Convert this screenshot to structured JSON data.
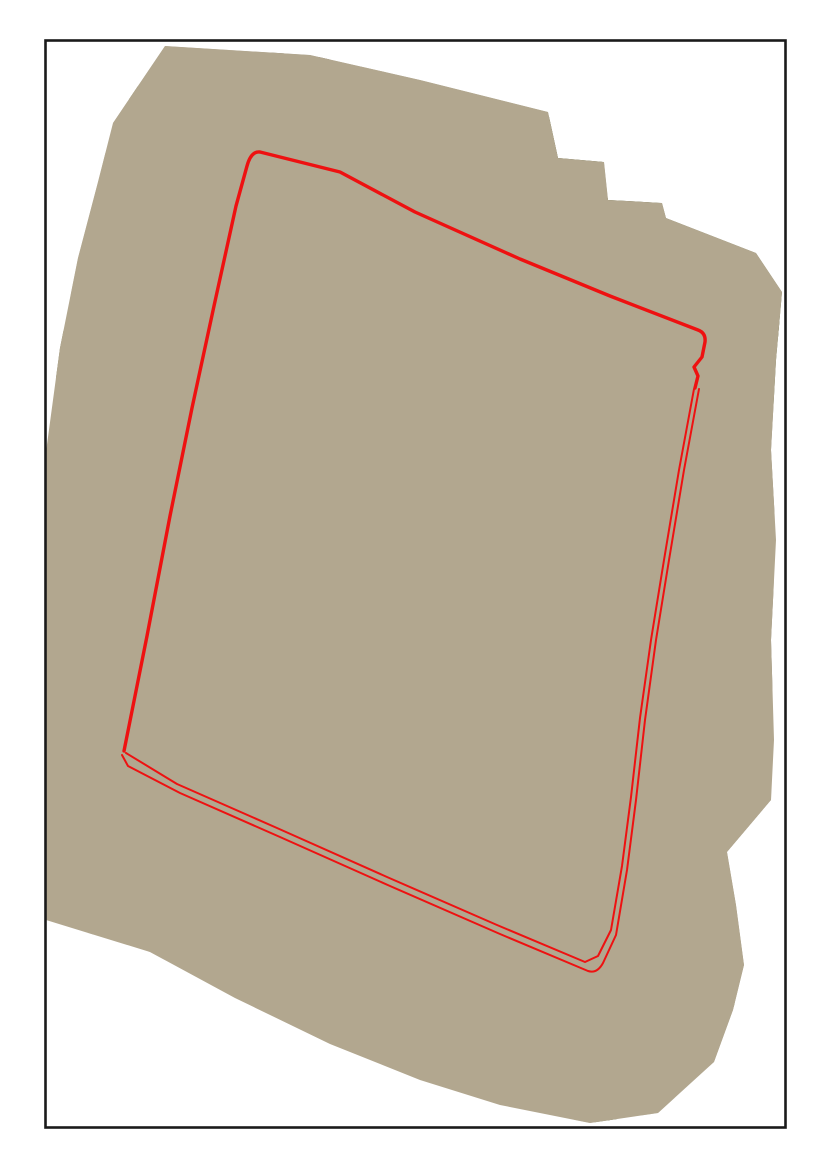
{
  "colors": {
    "page_background": "#ffffff",
    "frame_border": "#1a1a1a",
    "boundary_red": "#ee1111"
  },
  "scene": {
    "width": 830,
    "height": 1174,
    "bg": "#ffffff",
    "frame": {
      "x": 45.5,
      "y": 40.5,
      "w": 740,
      "h": 1087,
      "stroke": "#1a1a1a",
      "sw": 2.6
    },
    "footprint": {
      "points": "165,46 310,55 420,80 548,112 558,158 604,162 608,200 662,203 666,218 756,253 782,292 776,360 771,450 776,540 771,640 774,740 771,800 727,852 736,905 744,965 733,1010 714,1062 658,1113 590,1123 500,1105 420,1080 330,1044 235,998 150,952 46,920 46,452 60,348 78,258 98,182 113,123"
    },
    "gridquad": {
      "points": "258,150 703,334 583,966 123,752"
    },
    "layers": [
      {
        "t": "poly",
        "n": "footprint-base",
        "clip": "frame",
        "p": "165,46 310,55 420,80 548,112 558,158 604,162 608,200 662,203 666,218 756,253 782,292 776,360 771,450 776,540 771,640 774,740 771,800 727,852 736,905 744,965 733,1010 714,1062 658,1113 590,1123 500,1105 420,1080 330,1044 235,998 150,952 46,920 46,452 60,348 78,258 98,182 113,123",
        "f": "#b2a78f"
      },
      {
        "t": "poly",
        "n": "top-rubble-band",
        "p": "113,123 165,46 310,55 420,80 548,112 558,158 604,162 608,200 650,202 560,226 420,182 250,142 150,122",
        "f": "#a89f90"
      },
      {
        "t": "poly",
        "n": "field-green-top-1",
        "p": "288,58 352,66 350,96 286,88",
        "f": "#8e9465"
      },
      {
        "t": "poly",
        "n": "field-green-top-2",
        "p": "420,92 500,112 495,140 415,120",
        "f": "#87905f"
      },
      {
        "t": "ells",
        "n": "pond-pale-top",
        "items": [
          [
            372,
            74,
            15,
            10,
            15
          ]
        ],
        "f": "#ccc6b5"
      },
      {
        "t": "rects",
        "n": "buildings-top-row",
        "items": [
          [
            232,
            52,
            13,
            9,
            18,
            "#dcd8d0"
          ],
          [
            252,
            58,
            10,
            7,
            18,
            "#b0aba0"
          ],
          [
            278,
            52,
            12,
            9,
            18,
            "#8b8577"
          ],
          [
            300,
            63,
            10,
            7,
            18,
            "#e4e1da"
          ],
          [
            324,
            60,
            11,
            7,
            18,
            "#6f6a5c"
          ],
          [
            348,
            68,
            9,
            6,
            18,
            "#cfcabf"
          ]
        ]
      },
      {
        "t": "poly",
        "n": "water-dark-mass",
        "p": "548,116 602,160 606,198 662,203 666,218 756,253 782,292 776,405 700,390 640,330 592,262 556,205 538,158",
        "f": "#5b663f"
      },
      {
        "t": "poly",
        "n": "water-dark-blob",
        "p": "600,240 700,285 690,322 590,276",
        "f": "#4e5936",
        "o": 0.85
      },
      {
        "t": "path",
        "n": "canal-top",
        "d": "M132,92 L260,132 L420,190 L600,258 L710,300 L782,330",
        "s": "#6c7145",
        "w": 16
      },
      {
        "t": "path",
        "n": "road-top",
        "d": "M124,80 L260,118 L420,172 L600,242 L720,288 L782,314",
        "s": "#d9d4c4",
        "w": 5
      },
      {
        "t": "poly",
        "n": "pale-patch-topleft",
        "p": "90,150 140,160 120,320 70,300",
        "f": "#cac3b2"
      },
      {
        "t": "ells",
        "n": "ponds-olive-topleft",
        "items": [
          [
            170,
            128,
            13,
            22,
            -18
          ],
          [
            156,
            190,
            11,
            20,
            -12
          ]
        ],
        "f": "#6f7448"
      },
      {
        "t": "path",
        "n": "levee-left",
        "d": "M52,310 L80,470 L108,610 L128,720 L140,772",
        "s": "#7b7c4f",
        "w": 16,
        "o": 0.95
      },
      {
        "t": "poly",
        "n": "strip-olive-left",
        "p": "118,372 148,384 86,676 58,660",
        "f": "#8a8a60"
      },
      {
        "t": "poly",
        "n": "strip-bright-left",
        "p": "150,385 198,403 136,700 88,678",
        "f": "#d6d0c1"
      },
      {
        "t": "poly",
        "n": "strip-outside-1",
        "p": "168,258 190,267 128,543 106,534",
        "f": "#c9c2b1"
      },
      {
        "t": "poly",
        "n": "strip-outside-2",
        "p": "196,268 216,277 154,553 134,544",
        "f": "#8f8d6a"
      },
      {
        "t": "poly",
        "n": "strip-outside-3",
        "p": "222,278 238,285 176,561 160,554",
        "f": "#b3ab97"
      },
      {
        "t": "poly",
        "n": "pond-dikes-underlay",
        "clip": "grid",
        "p": "258,150 703,334 583,966 123,752",
        "f": "#6e6c4a"
      },
      {
        "t": "grid",
        "n": "pond-grid",
        "clip": "grid",
        "origin": [
          258,
          130
        ],
        "u": [
          57,
          14
        ],
        "v": [
          -12,
          52
        ],
        "inset": 0.94,
        "palette": {
          "0": "#b7ae9d",
          "1": "#a79d8a",
          "2": "#99937a",
          "3": "#8e9766",
          "4": "#7e8b55",
          "5": "#c9c2b2",
          "6": "#a0a07f",
          "7": "#6f7c49",
          "8": "#cfcabc",
          "9": "#90856f"
        },
        "rows": [
          "236323447",
          "125163344",
          "212902374",
          "105816243",
          "051523647",
          "100582334",
          "015106247",
          "509212334",
          "011586244",
          "150123637",
          "015012344",
          "201586237",
          "120152344",
          "015216237",
          "101523444"
        ]
      },
      {
        "t": "strips",
        "n": "strip-ponds-inner",
        "clip": "grid",
        "start": [
          150,
          545
        ],
        "step": [
          -6,
          27
        ],
        "u": [
          165,
          -38
        ],
        "v": [
          5,
          20
        ],
        "colors": [
          "#cbc3b2",
          "#9b9780",
          "#b4ac98",
          "#8f9168",
          "#c6bfae",
          "#a39c86",
          "#d2ccbd",
          "#96937a"
        ]
      },
      {
        "t": "path",
        "n": "margin-green-top",
        "clip": "grid",
        "d": "M268,162 L420,222 L560,278 L695,334",
        "s": "#83905a",
        "w": 11,
        "o": 0.85
      },
      {
        "t": "path",
        "n": "margin-green-right",
        "clip": "grid",
        "d": "M698,345 L676,470 L660,570 L648,670 L637,780 L627,870 L615,940 L592,960",
        "s": "#7e8b52",
        "w": 15,
        "o": 0.95
      },
      {
        "t": "path",
        "n": "margin-sand-bottom",
        "clip": "grid",
        "d": "M135,755 L300,830 L460,900 L575,955",
        "s": "#c5bca6",
        "w": 12,
        "o": 0.8
      },
      {
        "t": "ells",
        "n": "tone-light-overlays",
        "items": [
          [
            350,
            500,
            70,
            45,
            20
          ],
          [
            470,
            700,
            80,
            50,
            22
          ],
          [
            300,
            640,
            60,
            38,
            20
          ]
        ],
        "f": "#ffffff",
        "o": 0.14
      },
      {
        "t": "ells",
        "n": "tone-dark-overlays",
        "items": [
          [
            560,
            560,
            55,
            40,
            22
          ],
          [
            520,
            840,
            60,
            40,
            22
          ]
        ],
        "f": "#5d5a40",
        "o": 0.12
      },
      {
        "t": "poly",
        "n": "scrub-right",
        "p": "700,395 776,405 771,800 727,852 736,905 744,965 733,1010 714,1062 658,1108 652,1060 660,990 672,880 687,780 706,560",
        "f": "#8d8671"
      },
      {
        "t": "ells",
        "n": "scrub-mottle",
        "items": [
          [
            735,
            470,
            16,
            9,
            -75
          ],
          [
            750,
            540,
            14,
            8,
            -75
          ],
          [
            738,
            610,
            15,
            9,
            -70
          ],
          [
            730,
            690,
            13,
            8,
            -70
          ],
          [
            742,
            780,
            12,
            7,
            -70
          ]
        ],
        "f": "#6f6a52",
        "o": 0.55
      },
      {
        "t": "path",
        "n": "sand-corridor-village",
        "d": "M690,400 L668,560 L652,700 L638,840 L622,950 L640,1040",
        "s": "#c4baa2",
        "w": 26,
        "o": 0.9
      },
      {
        "t": "path",
        "n": "road-village",
        "d": "M730,470 L718,560 L710,620 L687,780 L672,880 L662,990 L656,1060",
        "s": "#d6d0c0",
        "w": 4.5
      },
      {
        "t": "ells",
        "n": "pond-olive-village",
        "items": [
          [
            668,
            640,
            11,
            14,
            -12
          ]
        ],
        "f": "#8f9158"
      },
      {
        "t": "poly",
        "n": "pond-green-right-1",
        "p": "672,912 722,930 735,1005 700,1048 668,1030 662,965",
        "f": "#8c955e"
      },
      {
        "t": "poly",
        "n": "pond-green-right-2",
        "p": "723,723 752,733 748,762 720,752",
        "f": "#87905a"
      },
      {
        "t": "rects",
        "n": "buildings-village",
        "items": [
          [
            706,
            508,
            12,
            8,
            -12,
            "#e7e5df"
          ],
          [
            718,
            556,
            14,
            9,
            -12,
            "#8fa3b0"
          ],
          [
            701,
            470,
            10,
            7,
            -12,
            "#b9b4a8"
          ],
          [
            658,
            646,
            13,
            9,
            -12,
            "#e2dfd8"
          ],
          [
            650,
            670,
            11,
            8,
            -12,
            "#6a655b"
          ],
          [
            666,
            682,
            10,
            7,
            -12,
            "#cdc9bf"
          ],
          [
            643,
            700,
            13,
            9,
            -12,
            "#dedbd3"
          ],
          [
            658,
            714,
            10,
            7,
            -12,
            "#99948a"
          ],
          [
            638,
            736,
            12,
            8,
            -12,
            "#e6e3dc"
          ],
          [
            653,
            750,
            10,
            7,
            -12,
            "#7b766c"
          ],
          [
            635,
            768,
            12,
            8,
            -12,
            "#d8d5cd"
          ],
          [
            648,
            784,
            10,
            7,
            -12,
            "#aaa599"
          ],
          [
            688,
            902,
            9,
            6,
            -12,
            "#55524b"
          ],
          [
            628,
            858,
            12,
            8,
            -12,
            "#e4e1da"
          ],
          [
            643,
            872,
            10,
            7,
            -12,
            "#8c877c"
          ],
          [
            620,
            890,
            12,
            8,
            -12,
            "#dcd9d1"
          ],
          [
            636,
            906,
            10,
            7,
            -12,
            "#6e6960"
          ],
          [
            616,
            928,
            12,
            8,
            -12,
            "#e0ddd5"
          ],
          [
            632,
            942,
            10,
            7,
            -12,
            "#a39e93"
          ],
          [
            613,
            962,
            11,
            8,
            -12,
            "#d6d3cb"
          ],
          [
            628,
            978,
            10,
            7,
            -12,
            "#8b99a4"
          ],
          [
            610,
            996,
            11,
            7,
            -12,
            "#e2dfd8"
          ],
          [
            626,
            1010,
            9,
            6,
            -12,
            "#77726a"
          ]
        ]
      },
      {
        "t": "ells",
        "n": "sand-bright-bottom",
        "items": [
          [
            180,
            835,
            90,
            22,
            21
          ],
          [
            430,
            950,
            120,
            26,
            23
          ],
          [
            590,
            1000,
            50,
            22,
            -20
          ]
        ],
        "f": "#d3caaf",
        "o": 0.85
      },
      {
        "t": "path",
        "n": "canal-green",
        "d": "M44,800 L180,848 L330,904 L470,957 L590,1001 L690,1040",
        "s": "#87935a",
        "w": 26
      },
      {
        "t": "path",
        "n": "canal-green-highlight",
        "d": "M44,800 L180,848 L330,904 L470,957 L590,1001 L690,1040",
        "s": "#9aa468",
        "w": 9,
        "o": 0.7
      },
      {
        "t": "ells",
        "n": "grass-blobs-left",
        "items": [
          [
            70,
            780,
            14,
            7,
            15
          ],
          [
            115,
            797,
            10,
            6,
            18
          ],
          [
            162,
            816,
            12,
            6,
            20
          ]
        ],
        "f": "#7f8a54",
        "o": 0.9
      },
      {
        "t": "path",
        "n": "highway-main",
        "d": "M44,868 L150,903 L300,958 L460,1020 L600,1075 L695,1118",
        "s": "#c9c6bc",
        "w": 20
      },
      {
        "t": "path",
        "n": "highway-second",
        "d": "M44,884 L150,919 L300,974 L460,1036 L600,1091 L688,1132",
        "s": "#d0cdc4",
        "w": 9,
        "o": 0.95
      },
      {
        "t": "path",
        "n": "highway-centerline",
        "d": "M44,868 L150,903 L300,958 L460,1020 L600,1075 L695,1118",
        "s": "#f2f2ee",
        "w": 1.4,
        "dash": "7 9"
      },
      {
        "t": "path",
        "n": "ramp-road",
        "d": "M46,838 L90,852 L135,878",
        "s": "#d2cfc5",
        "w": 6
      },
      {
        "t": "path",
        "n": "cross-road",
        "d": "M66,846 L84,902 L96,958",
        "s": "#d2cfc5",
        "w": 5
      },
      {
        "t": "rects",
        "n": "vehicles",
        "items": [
          [
            118,
            896,
            7,
            3.2,
            20,
            "#3c4043"
          ],
          [
            162,
            912,
            7,
            3.2,
            20,
            "#e8e8e6"
          ],
          [
            204,
            928,
            7,
            3.2,
            21,
            "#93382f"
          ],
          [
            252,
            945,
            8,
            3.4,
            21,
            "#51565f"
          ],
          [
            308,
            965,
            7,
            3.2,
            22,
            "#e4e4e2"
          ],
          [
            368,
            988,
            8,
            3.4,
            22,
            "#454a52"
          ],
          [
            428,
            1011,
            7,
            3.2,
            23,
            "#dfdfdd"
          ],
          [
            488,
            1034,
            7,
            3.2,
            23,
            "#3f444c"
          ],
          [
            543,
            1055,
            7,
            3.2,
            24,
            "#c2c2be"
          ],
          [
            95,
            888,
            11,
            4,
            18,
            "#35393f"
          ],
          [
            135,
            903,
            10,
            4,
            19,
            "#8e9298"
          ]
        ]
      },
      {
        "t": "dots",
        "n": "trees-row",
        "items": [
          [
            152,
            936,
            4
          ],
          [
            183,
            948,
            5
          ],
          [
            214,
            961,
            4
          ],
          [
            247,
            974,
            5
          ],
          [
            280,
            988,
            4
          ],
          [
            314,
            1001,
            5
          ],
          [
            349,
            1015,
            4
          ],
          [
            386,
            1030,
            5
          ],
          [
            424,
            1046,
            4
          ],
          [
            462,
            1061,
            5
          ],
          [
            500,
            1077,
            4
          ],
          [
            538,
            1092,
            5
          ],
          [
            576,
            1107,
            4
          ],
          [
            612,
            1120,
            5
          ],
          [
            645,
            1130,
            4
          ]
        ],
        "f": "#4a572f"
      },
      {
        "t": "path",
        "n": "road-lower",
        "d": "M150,952 L320,1018 L500,1088 L630,1140",
        "s": "#d6d3ca",
        "w": 4
      },
      {
        "t": "path",
        "n": "hedge-lower",
        "d": "M480,1075 L600,1120 L652,1140",
        "s": "#5d6b3d",
        "w": 8,
        "o": 0.8
      },
      {
        "t": "path",
        "n": "road-vertical-br",
        "d": "M668,1012 L655,1065 L648,1122",
        "s": "#d8d3c6",
        "w": 4
      },
      {
        "t": "path",
        "n": "boundary-main",
        "clip": "frame",
        "d": "M124,751 L147,636 L170,516 L192,408 L214,306 L236,206 L247,166 Q251,151 260,152 L340,172 L415,212 L520,259 L610,296 L698,330 Q706,333 705,342 L702,357 L694,367 L698,376 L695,388",
        "s": "#ee1111",
        "w": 3.4
      },
      {
        "t": "path",
        "n": "boundary-outer",
        "clip": "frame",
        "d": "M699,389 L684,470 L669,560 L656,640 L645,720 L636,800 L627,870 L616,935 L603,963 Q597,974 588,971 L500,934 L390,886 L280,837 L180,793 L128,766 L122,755",
        "s": "#ee1111",
        "w": 2
      },
      {
        "t": "path",
        "n": "boundary-inner",
        "clip": "frame",
        "d": "M694,389 L679,470 L664,560 L651,640 L640,718 L631,797 L622,866 L611,930 L598,956 L585,962 L497,925 L387,877 L277,828 L177,784 L126,753",
        "s": "#ee1111",
        "w": 2
      }
    ]
  }
}
